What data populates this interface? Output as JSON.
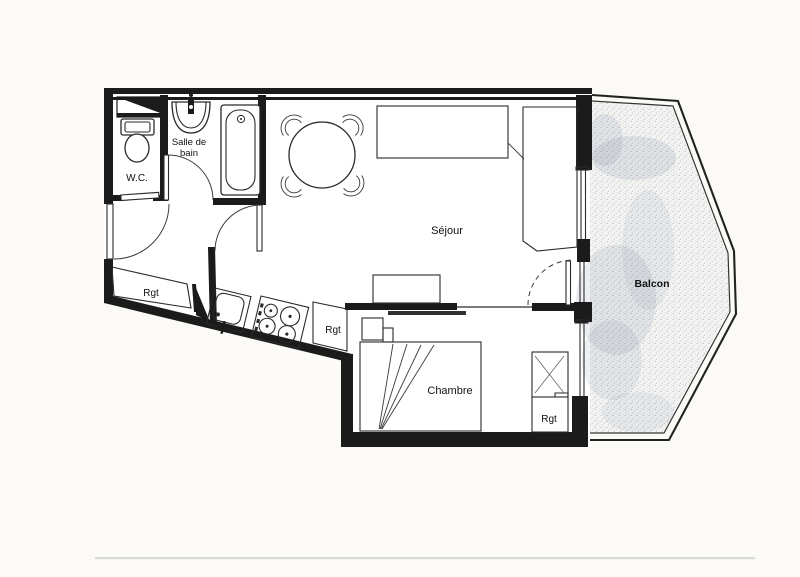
{
  "document": {
    "kind": "apartment floor plan (scanned)",
    "rooms": {
      "sejour": "Séjour",
      "chambre": "Chambre",
      "balcon": "Balcon",
      "bath_line1": "Salle de",
      "bath_line2": "bain",
      "wc": "W.C.",
      "rgt_hall": "Rgt",
      "rgt_kitchen": "Rgt",
      "rgt_chambre": "Rgt"
    },
    "fixtures": [
      "toilet-icon",
      "washbasin-icon",
      "bathtub-icon",
      "dining-table-icon",
      "chair-icon",
      "sideboard-icon",
      "sofa-icon",
      "low-cabinet-icon",
      "kitchen-sink-icon",
      "stove-icon",
      "bed-icon",
      "pillow-icon",
      "shelf-icon",
      "wardrobe-icon",
      "duct-icon",
      "door-swing-icon",
      "sliding-window-icon",
      "balcony-railing-icon"
    ],
    "colors": {
      "ink": "#1b1b1b",
      "paper": "#fbfaf7",
      "room_fill": "#ffffff",
      "balcony_stipple": "#8d96a4",
      "scan_artifact": "#bdbdbd"
    }
  }
}
